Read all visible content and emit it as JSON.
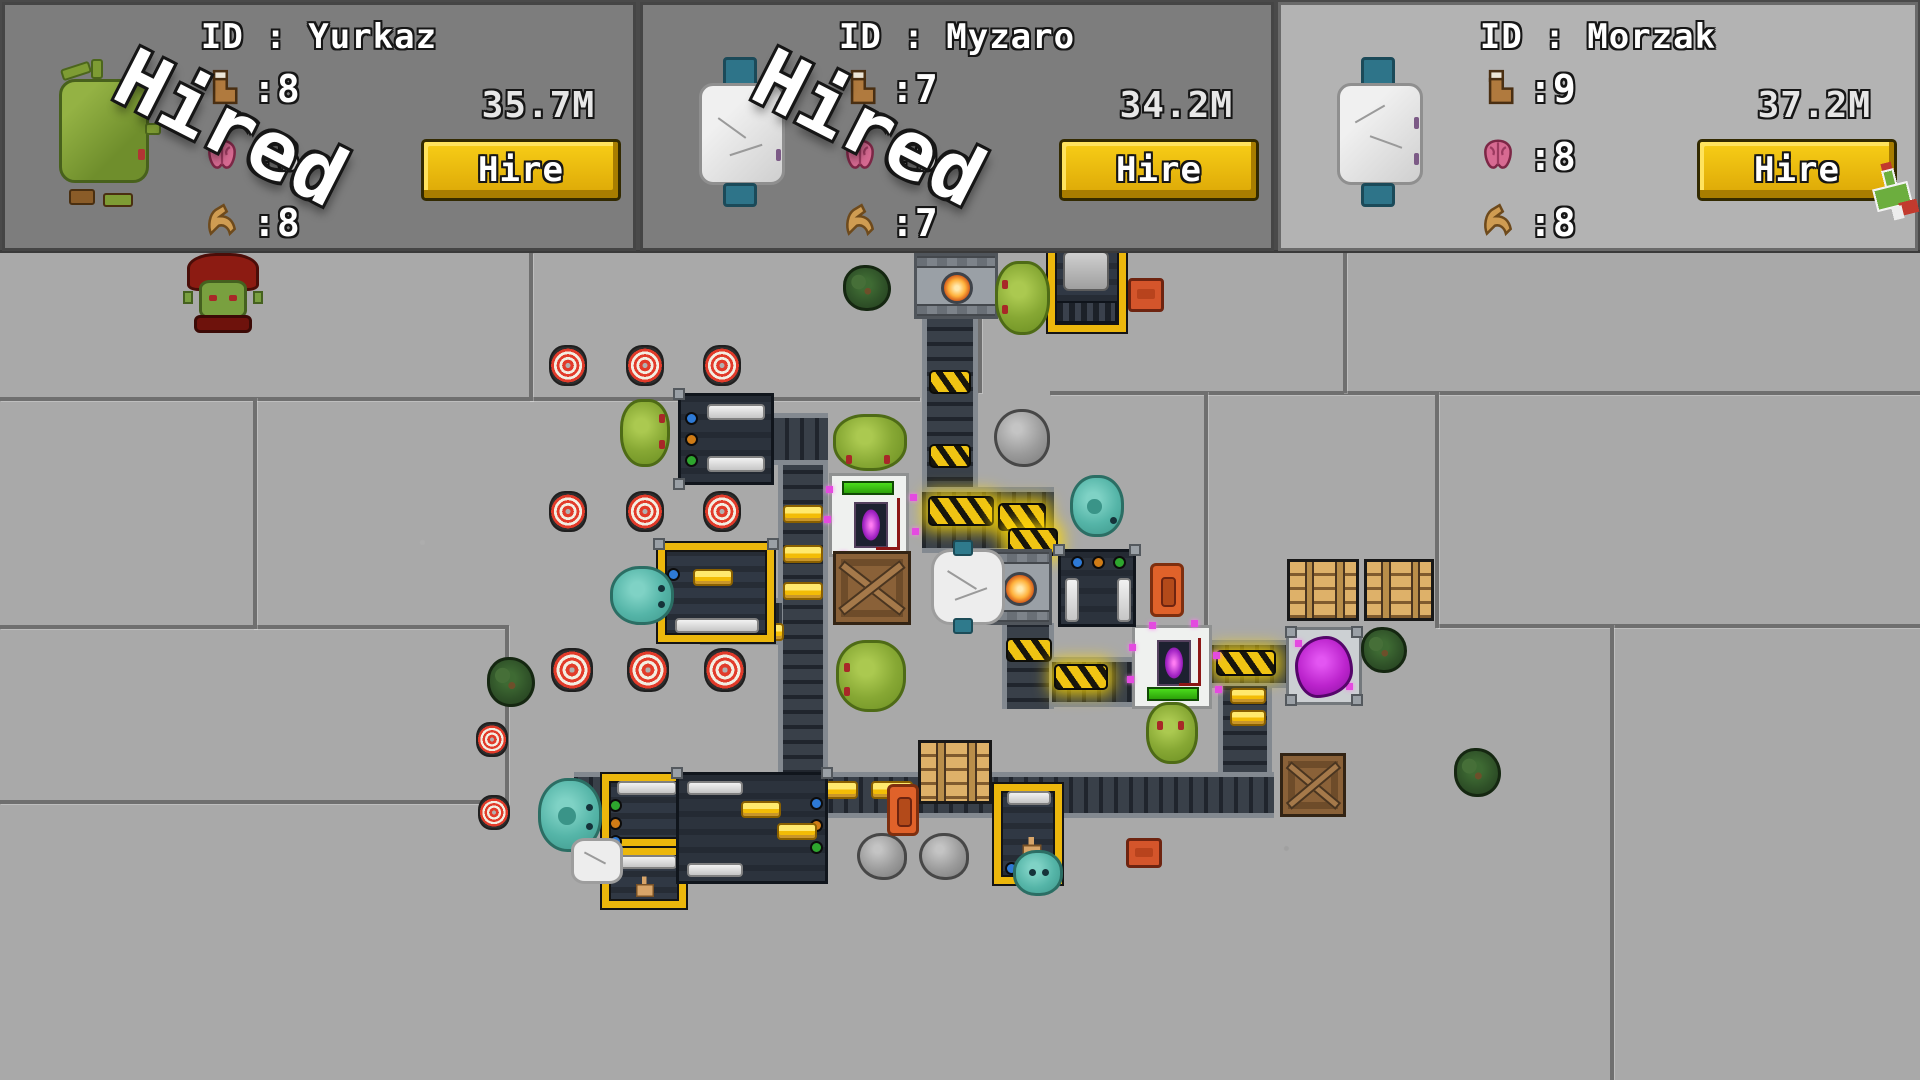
{
  "panels": [
    {
      "id_label": "ID : Yurkaz",
      "avatar": "green-orc",
      "boot": ":8",
      "brain": ":8",
      "muscle": ":8",
      "price": "35.7M",
      "hire_label": "Hire",
      "stamp_label": "Hired",
      "hired": true
    },
    {
      "id_label": "ID : Myzaro",
      "avatar": "white-golem",
      "boot": ":7",
      "brain": ":9",
      "muscle": ":7",
      "price": "34.2M",
      "hire_label": "Hire",
      "stamp_label": "Hired",
      "hired": true
    },
    {
      "id_label": "ID : Morzak",
      "avatar": "white-golem",
      "boot": ":9",
      "brain": ":8",
      "muscle": ":8",
      "price": "37.2M",
      "hire_label": "Hire",
      "stamp_label": "",
      "hired": false,
      "hovered": true
    }
  ],
  "stat_icons": [
    "boot-icon",
    "brain-icon",
    "muscle-icon"
  ],
  "colors": {
    "panel_bg": "#7d7d7d",
    "panel_bg_highlight": "#b3b3b3",
    "floor": "#a9a9a9",
    "grout": "#6f6f6f",
    "hire_gold": "#eab308",
    "belt": "#2e333c",
    "gold_item": "#f7c81e",
    "target_red": "#e23b2a",
    "slime_green": "#87a834",
    "slime_teal": "#55b5a8",
    "stamp_white": "#ffffff"
  }
}
